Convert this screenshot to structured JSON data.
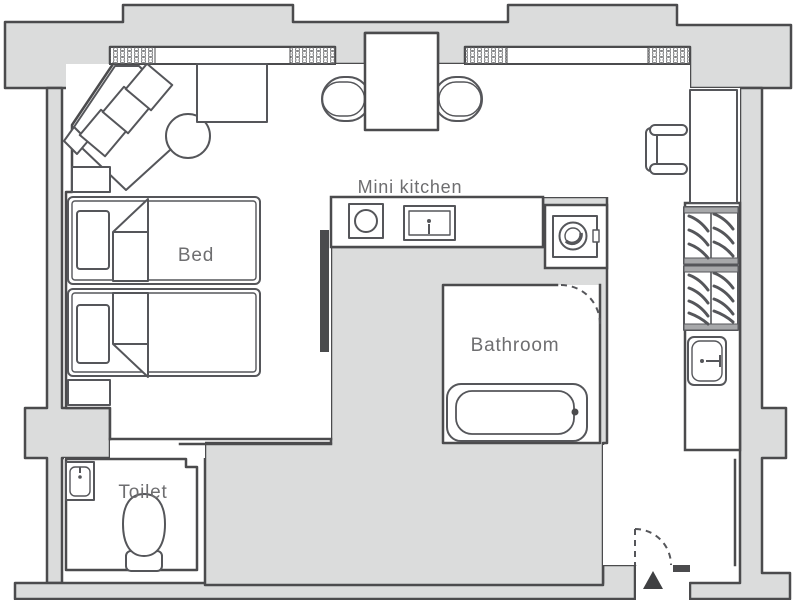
{
  "floorplan": {
    "title": "Room floor plan",
    "labels": {
      "bed": "Bed",
      "mini_kitchen": "Mini kitchen",
      "bathroom": "Bathroom",
      "toilet": "Toilet"
    },
    "colors": {
      "structure_fill": "#dbdcdc",
      "wall_line": "#4b4b4d",
      "furniture_line": "#55565a",
      "label_text": "#6e6e70",
      "entrance_marker": "#3f4042",
      "window_hatch": "#7d7e80",
      "background": "#ffffff"
    },
    "fixtures": [
      {
        "name": "corner-sofa-icon",
        "shape": "diagonal band with three rotated cushions"
      },
      {
        "name": "round-table-icon",
        "shape": "circle"
      },
      {
        "name": "side-cabinet-icon",
        "shape": "rectangle"
      },
      {
        "name": "dining-table-icon",
        "shape": "rectangle with two capsule chairs"
      },
      {
        "name": "twin-bed-icon",
        "shape": "rounded rectangle with pillow and folded blanket"
      },
      {
        "name": "tv-board-icon",
        "shape": "dark thin bar"
      },
      {
        "name": "stove-icon",
        "shape": "square with circle burner"
      },
      {
        "name": "kitchen-sink-icon",
        "shape": "double rectangle with faucet dot"
      },
      {
        "name": "washing-machine-icon",
        "shape": "square with drum circle"
      },
      {
        "name": "desk-icon",
        "shape": "tall rectangle"
      },
      {
        "name": "desk-chair-icon",
        "shape": "bracket seat"
      },
      {
        "name": "wardrobe-hangers-icon",
        "shape": "rail with slanted hanger strokes"
      },
      {
        "name": "washbasin-icon",
        "shape": "rounded rectangle with faucet"
      },
      {
        "name": "bathtub-icon",
        "shape": "double rounded rectangle with drain dot"
      },
      {
        "name": "toilet-bowl-icon",
        "shape": "egg shape with base"
      },
      {
        "name": "door-swing-icon",
        "shape": "dashed quarter arc"
      },
      {
        "name": "entrance-marker-icon",
        "shape": "solid triangle"
      },
      {
        "name": "window-icon",
        "shape": "hatched wall strip"
      }
    ]
  }
}
